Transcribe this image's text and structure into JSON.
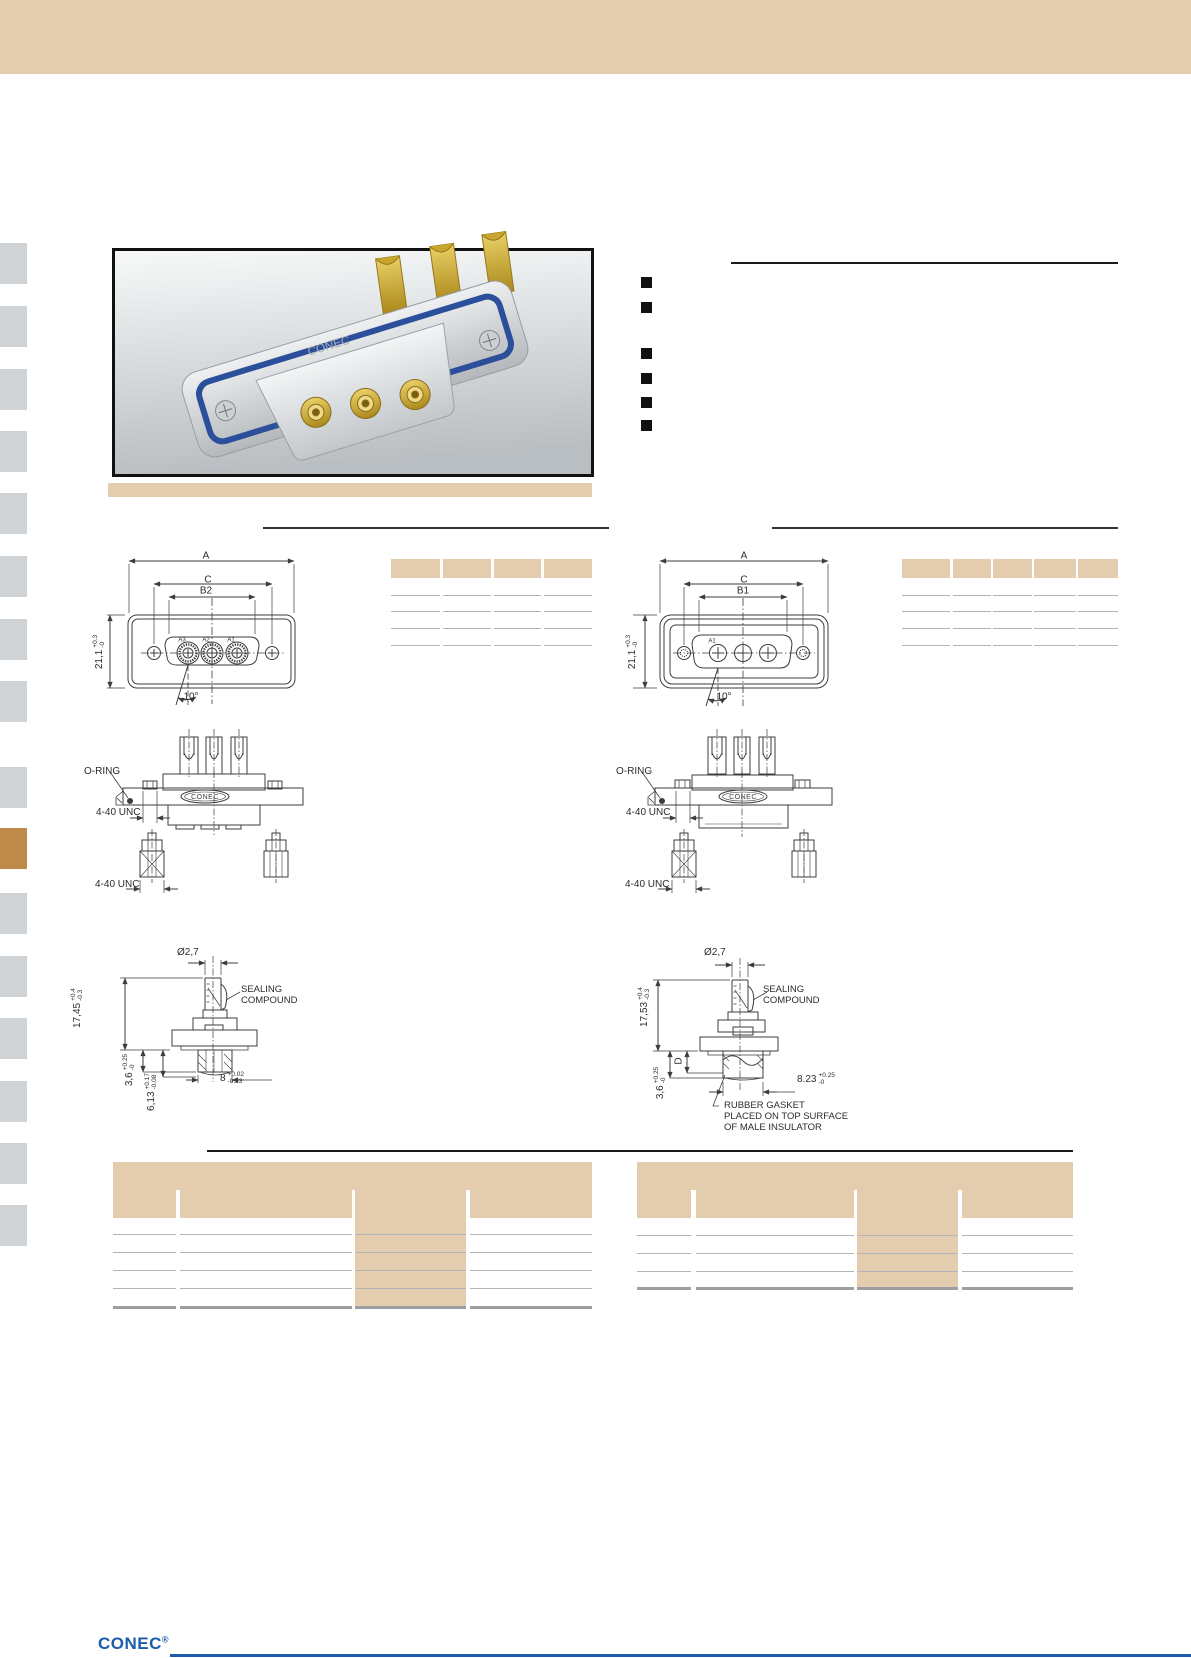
{
  "theme": {
    "tan": "#e3cdae",
    "sidebar_gray": "#d0d3d5",
    "sidebar_orange": "#bd8a4a",
    "logo_blue": "#1b5dab",
    "draw_line": "#3d3d3d",
    "table_line": "#b2b5b7",
    "table_line_strong": "#9c9fa1"
  },
  "sidebar": {
    "tab_count": 16,
    "active_index": 9
  },
  "intro": {
    "bullets": [
      "",
      "",
      "",
      "",
      "",
      ""
    ]
  },
  "photo": {
    "brand": "CONEC"
  },
  "drawings": {
    "front_left": {
      "dim_a": "A",
      "dim_c": "C",
      "dim_b": "B2",
      "height": {
        "v": "21,1",
        "plus": "+0.3",
        "minus": "-0"
      },
      "angle": "10°",
      "contacts": [
        "A3",
        "A2",
        "A1"
      ]
    },
    "front_right": {
      "dim_a": "A",
      "dim_c": "C",
      "dim_b": "B1",
      "height": {
        "v": "21,1",
        "plus": "+0.3",
        "minus": "-0"
      },
      "angle": "10°",
      "contact": "A1"
    },
    "side_left": {
      "oring": "O-RING",
      "flange_thread": "4-40 UNC",
      "screw_thread": "4-40 UNC",
      "brand": "CONEC"
    },
    "side_right": {
      "oring": "O-RING",
      "flange_thread": "4-40 UNC",
      "screw_thread": "4-40 UNC",
      "brand": "CONEC"
    },
    "contact_left": {
      "dia": "Ø2,7",
      "seal": "SEALING\nCOMPOUND",
      "total": {
        "v": "17,45",
        "plus": "+0.4",
        "minus": "-0.3"
      },
      "d1": {
        "v": "3,6",
        "plus": "+0.25",
        "minus": "-0"
      },
      "d2": {
        "v": "6,13",
        "plus": "+0.17",
        "minus": "-0.08"
      },
      "w": {
        "v": "8",
        "plus": "+0.02",
        "minus": "-0.23"
      }
    },
    "contact_right": {
      "dia": "Ø2,7",
      "seal": "SEALING\nCOMPOUND",
      "total": {
        "v": "17,53",
        "plus": "+0.4",
        "minus": "-0.3"
      },
      "d_label": "D",
      "d1": {
        "v": "3,6",
        "plus": "+0.25",
        "minus": "-0"
      },
      "w": {
        "v": "8.23",
        "plus": "+0.25",
        "minus": "-0"
      },
      "gasket_note": "RUBBER GASKET\nPLACED ON TOP SURFACE\nOF MALE INSULATOR"
    }
  },
  "tables": {
    "dims_left": {
      "columns": 4,
      "rows": 4
    },
    "dims_right": {
      "columns": 5,
      "rows": 4
    },
    "parts_left": {
      "columns": 4,
      "rows": 5,
      "highlight_column": 3
    },
    "parts_right": {
      "columns": 4,
      "rows": 4,
      "highlight_column": 3
    }
  },
  "footer": {
    "logo": "CONEC",
    "reg": "®"
  }
}
